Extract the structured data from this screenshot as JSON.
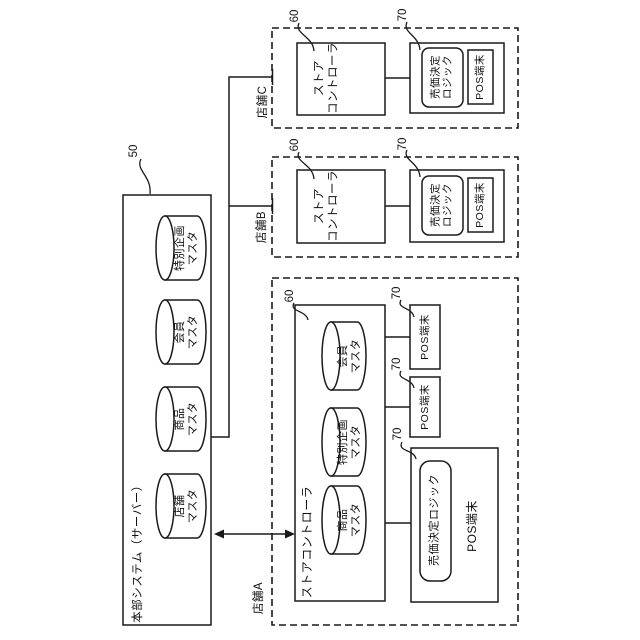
{
  "diagram": {
    "hq": {
      "ref": "50",
      "title": "本部システム（サーバー）",
      "db": [
        "特別企画\nマスタ",
        "会員\nマスタ",
        "商品\nマスタ",
        "店舗\nマスタ"
      ]
    },
    "storeC": {
      "label": "店舗C",
      "ref_controller": "60",
      "controller": "ストア\nコントローラ",
      "ref_pos": "70",
      "logic": "売価決定\nロジック",
      "pos": "POS端末"
    },
    "storeB": {
      "label": "店舗B",
      "ref_controller": "60",
      "controller": "ストア\nコントローラ",
      "ref_pos": "70",
      "logic": "売価決定\nロジック",
      "pos": "POS端末"
    },
    "storeA": {
      "label": "店舗A",
      "ref_controller": "60",
      "controller": "ストアコントローラ",
      "db": [
        "会員\nマスタ",
        "特別企画\nマスタ",
        "商品\nマスタ"
      ],
      "ref_pos1": "70",
      "pos1": "POS端末",
      "ref_pos2": "70",
      "pos2": "POS端末",
      "ref_pos_main": "70",
      "logic": "売価決定ロジック",
      "pos_main": "POS端末"
    }
  }
}
